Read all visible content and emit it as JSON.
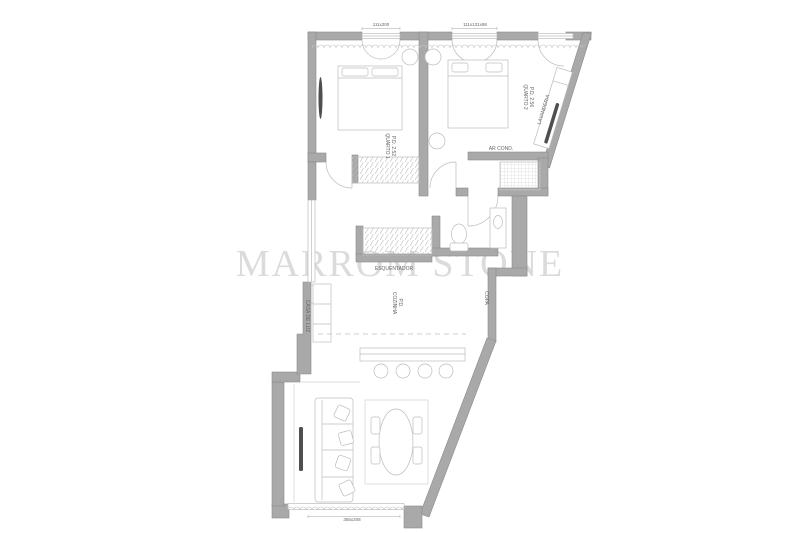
{
  "watermark": "MARROM STONE",
  "dimensions": {
    "top_left": "111x200",
    "top_right": "111x131x98",
    "bottom": "355x208"
  },
  "labels": {
    "quarto1_name": "QUARTO 1",
    "quarto1_pd": "P.D. 2.52",
    "quarto2_name": "QUARTO 2",
    "quarto2_pd": "P.D. 2.56",
    "lavanderia": "LAVANDERIA",
    "ar_cond": "AR COND.",
    "esquentador": "ESQUENTADOR",
    "cozinha_name": "COZINHA",
    "cozinha_pd": "P.D.",
    "copa": "COPA",
    "casa_de_luz": "CASA DE LUZ"
  },
  "colors": {
    "background": "#ffffff",
    "wall_fill": "#a9a9a9",
    "wall_stroke": "#8a8a8a",
    "line": "#bcbcbc",
    "faint": "#d2d2d2",
    "dark": "#4f4f4f",
    "text": "#666666",
    "watermark": "#dbdbdb"
  }
}
